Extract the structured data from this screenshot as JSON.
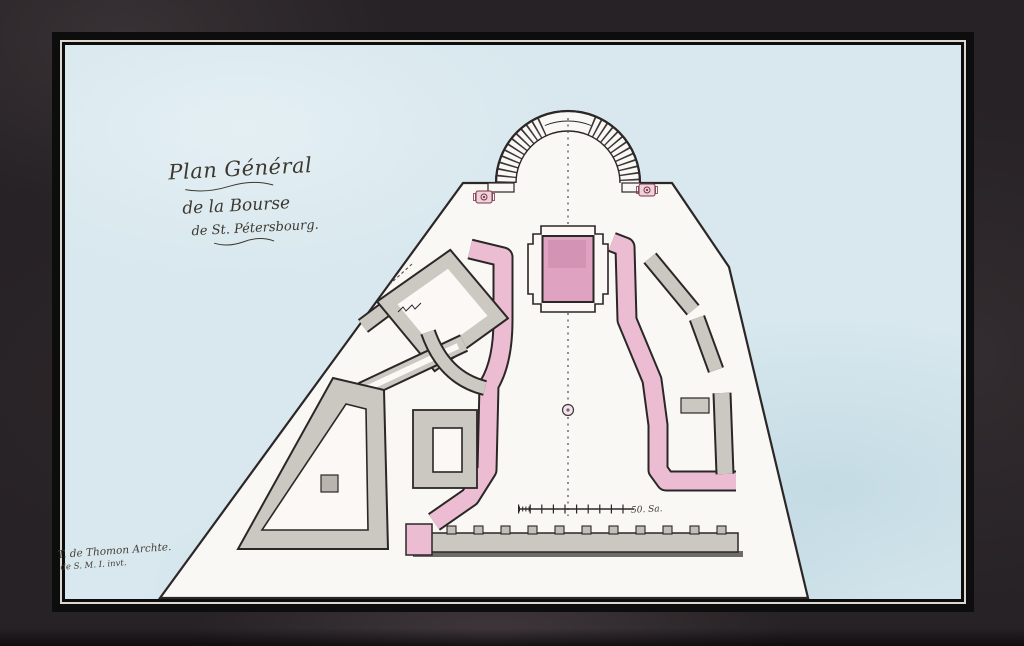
{
  "artwork": {
    "title_line1": "Plan Général",
    "title_line2": "de la Bourse",
    "title_line3": "de St. Pétersbourg.",
    "signature_line1": "T. de Thomon Archte.",
    "signature_line2": "de S. M. I. invt.",
    "scale_label": "50. Sa."
  },
  "colors": {
    "mat": "#272225",
    "frame": "#0e0d0d",
    "pinstripe": "#dcd7cf",
    "water": "#d8e8ee",
    "land": "#faf8f5",
    "ink": "#2b2727",
    "building_gray": "#cbc7c1",
    "accent_pink": "#ecbdd2",
    "bourse_pink": "#dfa3c1",
    "rosette_red": "#7d3648"
  }
}
